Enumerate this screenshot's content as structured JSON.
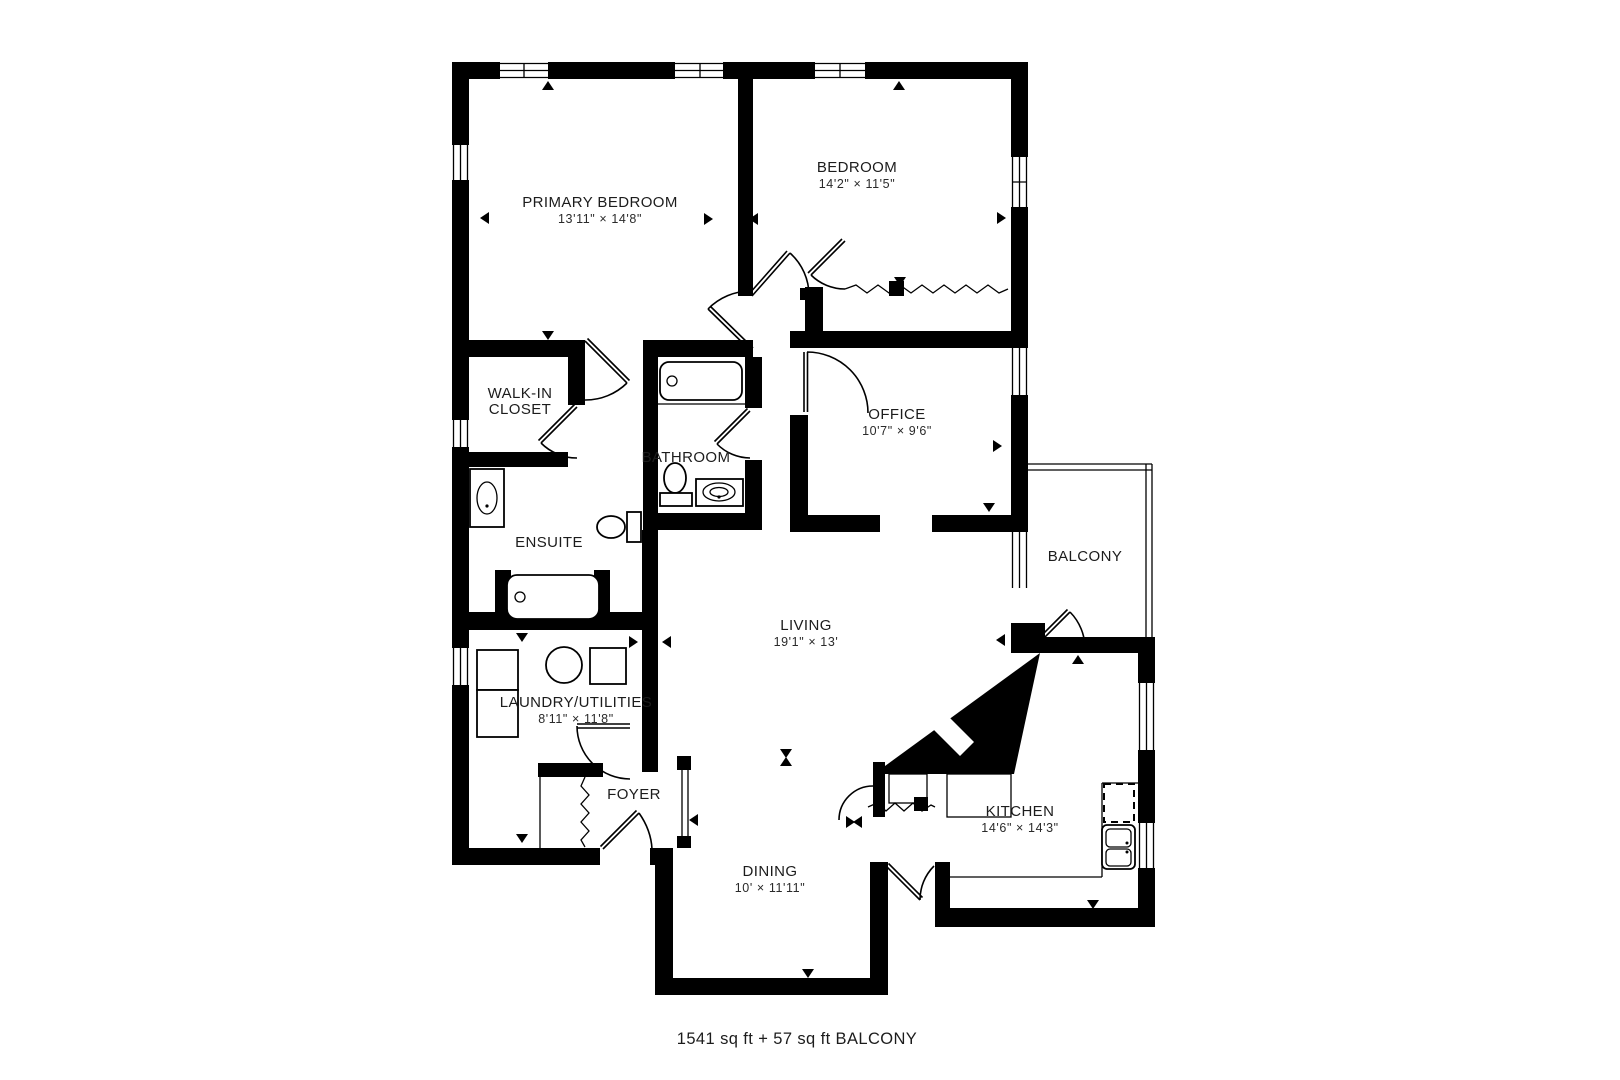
{
  "footer": "1541 sq ft + 57 sq ft BALCONY",
  "colors": {
    "wall": "#000000",
    "background": "#ffffff",
    "text": "#1c1c1c"
  },
  "rooms": {
    "primary": {
      "name": "PRIMARY BEDROOM",
      "dims": "13'11\" × 14'8\""
    },
    "bedroom": {
      "name": "BEDROOM",
      "dims": "14'2\" × 11'5\""
    },
    "walkin": {
      "line1": "WALK-IN",
      "line2": "CLOSET"
    },
    "bathroom": {
      "name": "BATHROOM"
    },
    "office": {
      "name": "OFFICE",
      "dims": "10'7\" × 9'6\""
    },
    "ensuite": {
      "name": "ENSUITE"
    },
    "balcony": {
      "name": "BALCONY"
    },
    "living": {
      "name": "LIVING",
      "dims": "19'1\" × 13'"
    },
    "laundry": {
      "name": "LAUNDRY/UTILITIES",
      "dims": "8'11\" × 11'8\""
    },
    "foyer": {
      "name": "FOYER"
    },
    "kitchen": {
      "name": "KITCHEN",
      "dims": "14'6\" × 14'3\""
    },
    "dining": {
      "name": "DINING",
      "dims": "10' × 11'11\""
    }
  }
}
